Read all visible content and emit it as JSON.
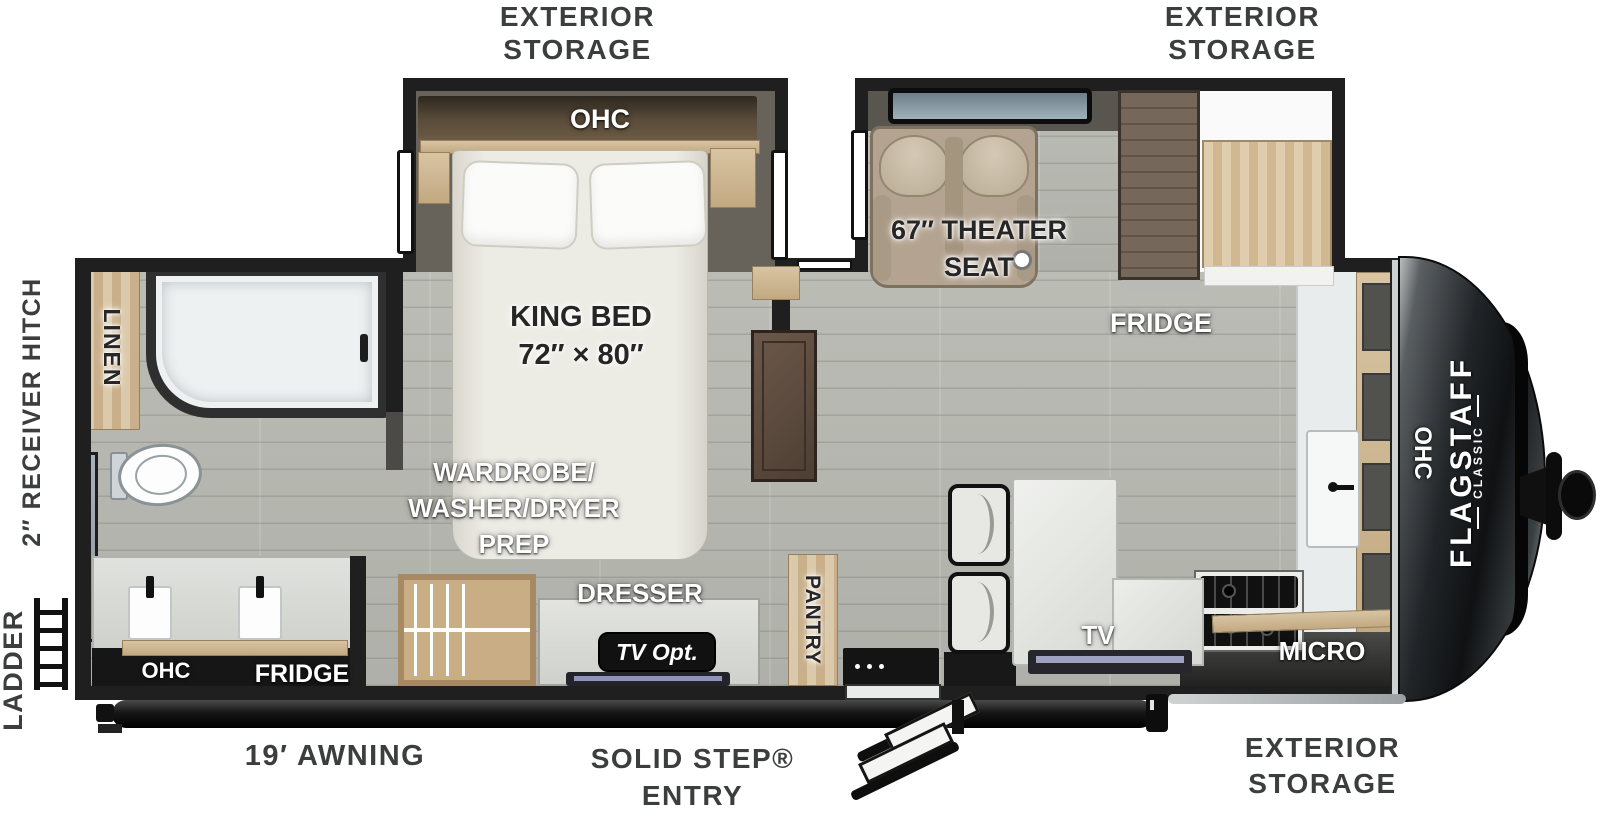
{
  "labels": {
    "exterior_storage": "EXTERIOR\nSTORAGE",
    "awning": "19′ AWNING",
    "solid_step_entry": "SOLID STEP®\nENTRY",
    "receiver_hitch": "2″ RECEIVER HITCH",
    "ladder": "LADDER"
  },
  "bedroom": {
    "ohc": "OHC",
    "king_bed": "KING BED\n72″ × 80″"
  },
  "bathroom": {
    "linen": "LINEN",
    "ohc": "OHC",
    "fridge": "FRIDGE"
  },
  "living": {
    "theater_seat": "67″ THEATER\nSEAT",
    "fridge": "FRIDGE",
    "tv": "TV"
  },
  "kitchen": {
    "micro": "MICRO",
    "ohc": "OHC",
    "pantry": "PANTRY"
  },
  "utility": {
    "wardrobe": "WARDROBE/\nWASHER/DRYER\nPREP",
    "dresser": "DRESSER",
    "tv_opt": "TV Opt."
  },
  "brand": {
    "name": "FLAGSTAFF",
    "series": "CLASSIC"
  },
  "colors": {
    "wall": "#1f1f1f",
    "floor": "#b6b7b0",
    "wood_light": "#d3bd99",
    "wood_dark": "#6b5d4e",
    "cap_dark": "#16191b",
    "label_dark": "#3c3d3d",
    "seat_beige": "#b3a390",
    "badge_black": "#111111"
  }
}
